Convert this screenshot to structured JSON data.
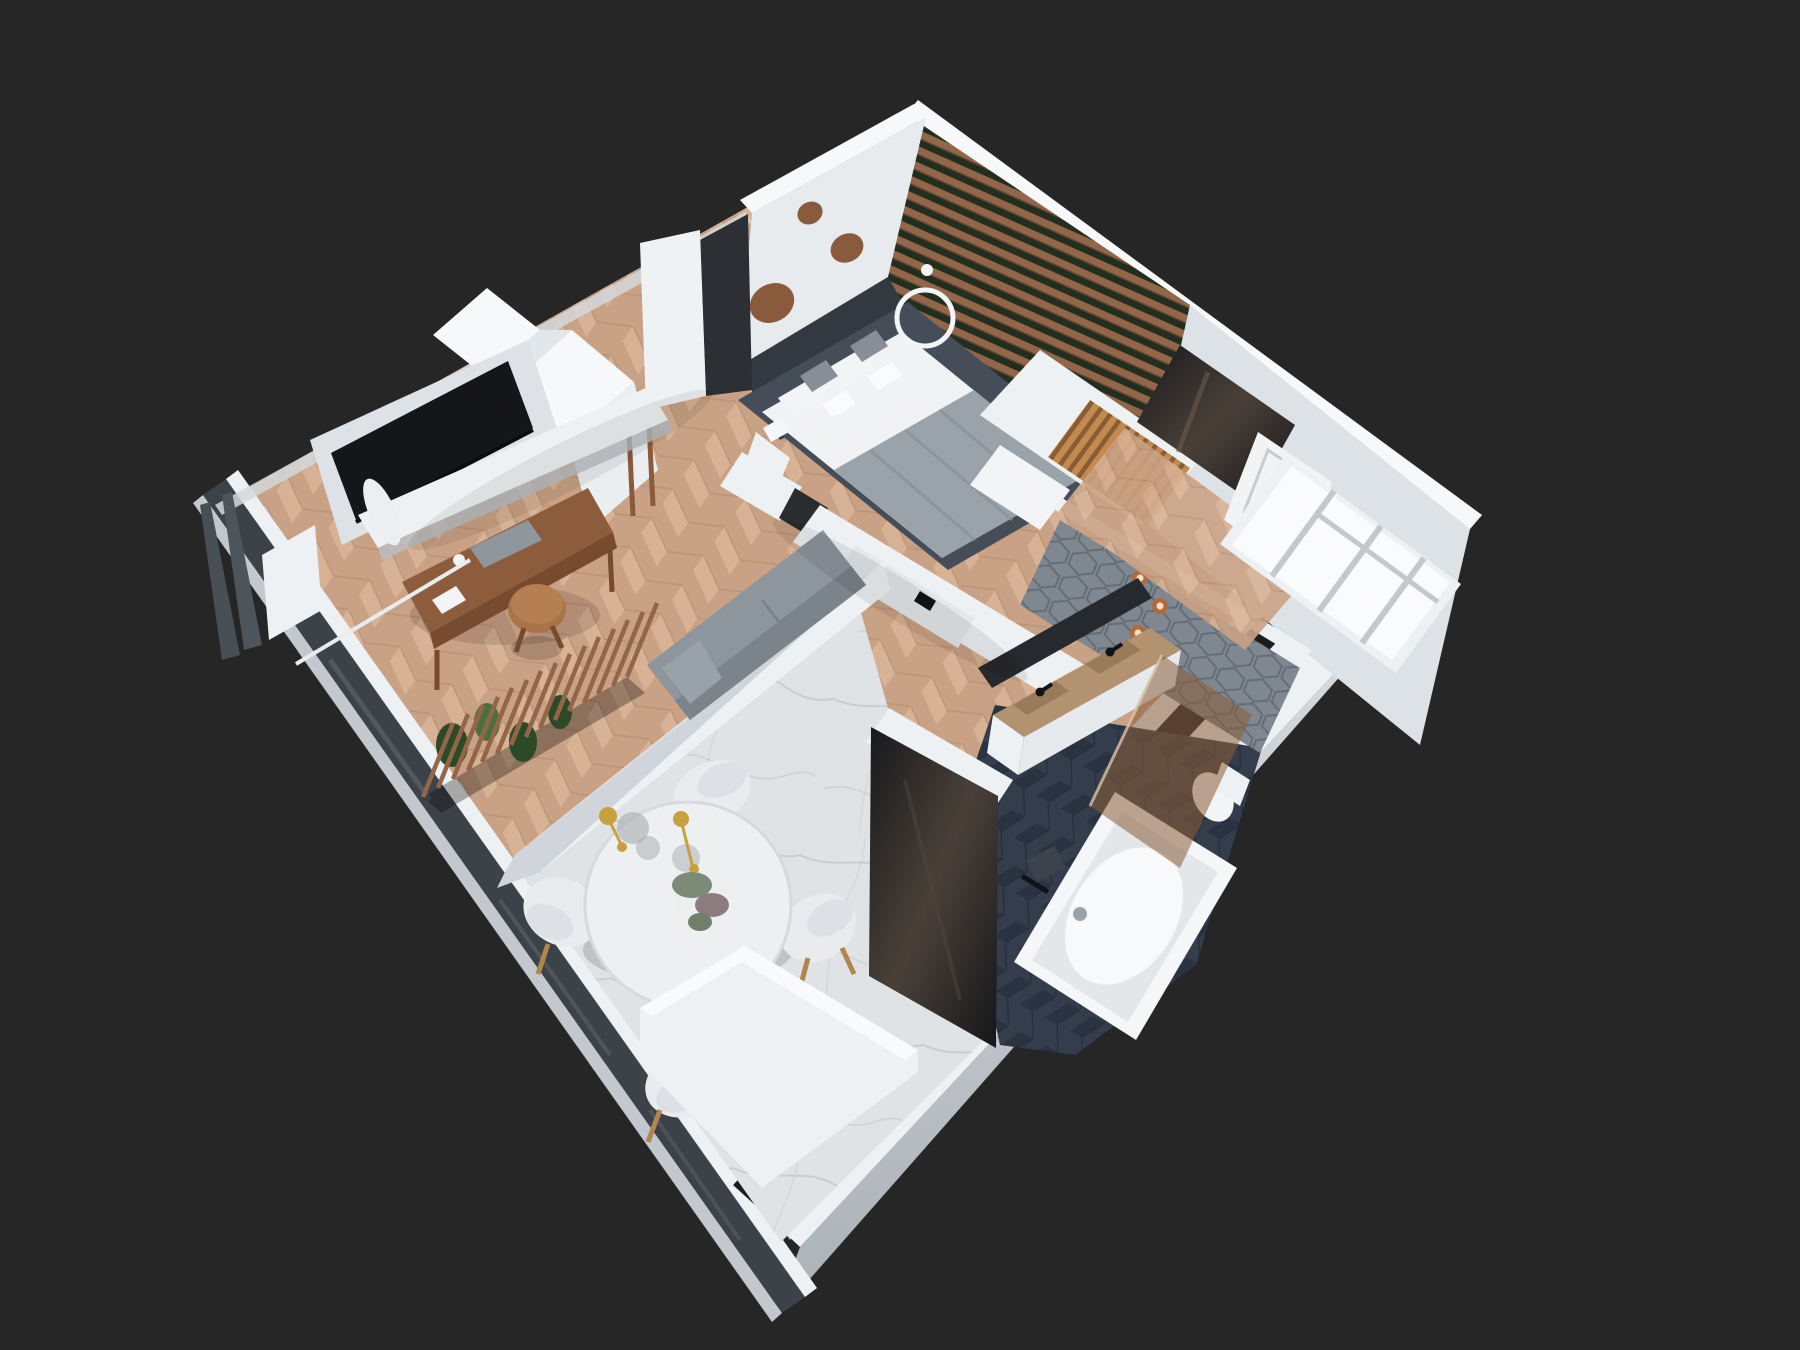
{
  "scene": {
    "type": "3d-floorplan-render",
    "view": "top-down isometric cutaway",
    "rooms": [
      {
        "name": "bedroom",
        "furniture": [
          "double-bed",
          "dark-headboard-wall",
          "wood-circle-decor",
          "wood-slat-plant-wall",
          "ring-pendant-light",
          "oak-slat-wardrobe",
          "bench"
        ]
      },
      {
        "name": "living-area",
        "furniture": [
          "tv",
          "media-shelf",
          "wardrobes",
          "dressing-desk",
          "round-stool",
          "sofa",
          "wood-slat-divider",
          "plants",
          "curtain",
          "herringbone-floor"
        ]
      },
      {
        "name": "dining-area",
        "furniture": [
          "round-table",
          "shell-chairs",
          "gold-pendant-lamp",
          "plant-centerpiece",
          "marble-floor",
          "sideboard"
        ]
      },
      {
        "name": "bathroom",
        "furniture": [
          "double-vanity",
          "black-faucets",
          "hex-tile-wall",
          "copper-spotlights",
          "bathtub",
          "bronze-glass-screen",
          "toilet",
          "mirror-panel",
          "navy-herringbone-floor"
        ]
      },
      {
        "name": "hallway",
        "furniture": [
          "entrance-door",
          "open-shelf-closet",
          "mirror-wall",
          "chevron-floor"
        ]
      }
    ]
  },
  "palette": {
    "bg": "#262626",
    "wallTop": "#eef1f3",
    "wallBright": "#f6f8f9",
    "wallFace": "#dde2e6",
    "wallShade": "#c2c8cd",
    "wallEdge": "#aab1b7",
    "floorWood": "#c9a184",
    "floorWoodLight": "#d8b294",
    "floorWoodSeam": "#b18a6c",
    "marble": "#e0e3e5",
    "marbleVein": "#bfc4c8",
    "navy": "#333d4b",
    "navyDark": "#2a3341",
    "hexTile": "#7f8891",
    "hexLine": "#646d76",
    "slat": "#93664a",
    "slatGap": "#222e1e",
    "walnut": "#8a5a3d",
    "oakSlat": "#c28a4e",
    "oakDark": "#8a5c33",
    "deskWood": "#8d5c3c",
    "deskWoodDark": "#774b30",
    "stoolWood": "#a9744a",
    "tv": "#141619",
    "sofa": "#8d959d",
    "sofaBack": "#7b838b",
    "bedPlatform": "#454e58",
    "headboard": "#323941",
    "mattress": "#f1f2f4",
    "blanket": "#9aa2aa",
    "blanketFold": "#8a929a",
    "pillow": "#868e96",
    "table": "#edeff0",
    "chair": "#e9ebee",
    "chairLeg": "#b08550",
    "gold": "#c7a13e",
    "glassBubble": "#aab0b5",
    "mirror": "#1f2226",
    "mirrorSheen": "#4a4038",
    "bronze": "#8a5c38",
    "tub": "#f4f6f8",
    "tubInner": "#e3e7ea",
    "vanity": "#b3926f",
    "vanityDark": "#997a59",
    "copper": "#b06a3c",
    "glassWall": "#3b4248",
    "glassStreak": "#575f66",
    "windowDark": "#1a1d20",
    "plant": "#2c4a28",
    "plantLight": "#49703f",
    "door": "#f1f3f5",
    "doorLine": "#c6ccd1",
    "black": "#111417",
    "ringLight": "#f2f4f5",
    "shadow": "#000000"
  }
}
